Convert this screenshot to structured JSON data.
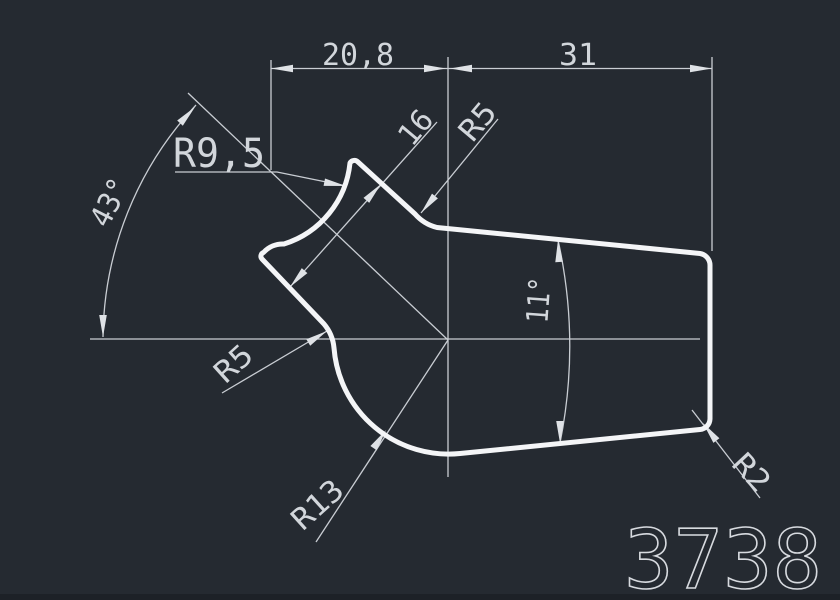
{
  "canvas": {
    "type": "cad-drawing",
    "part_number": "3738",
    "colors": {
      "background": "#252a31",
      "outline": "#f4f5f7",
      "dimension_lines": "#c9cdd3",
      "text": "#d2d6db"
    }
  },
  "labels": {
    "dim_top_left": "20,8",
    "dim_top_right": "31",
    "radius_groove": "R9,5",
    "angle_notch": "43°",
    "dim_notch_width": "16",
    "radius_top_fillet": "R5",
    "angle_taper": "11°",
    "radius_notch_fillet": "R5",
    "radius_bottom_arc": "R13",
    "radius_corner": "R2",
    "part_number": "3738"
  }
}
